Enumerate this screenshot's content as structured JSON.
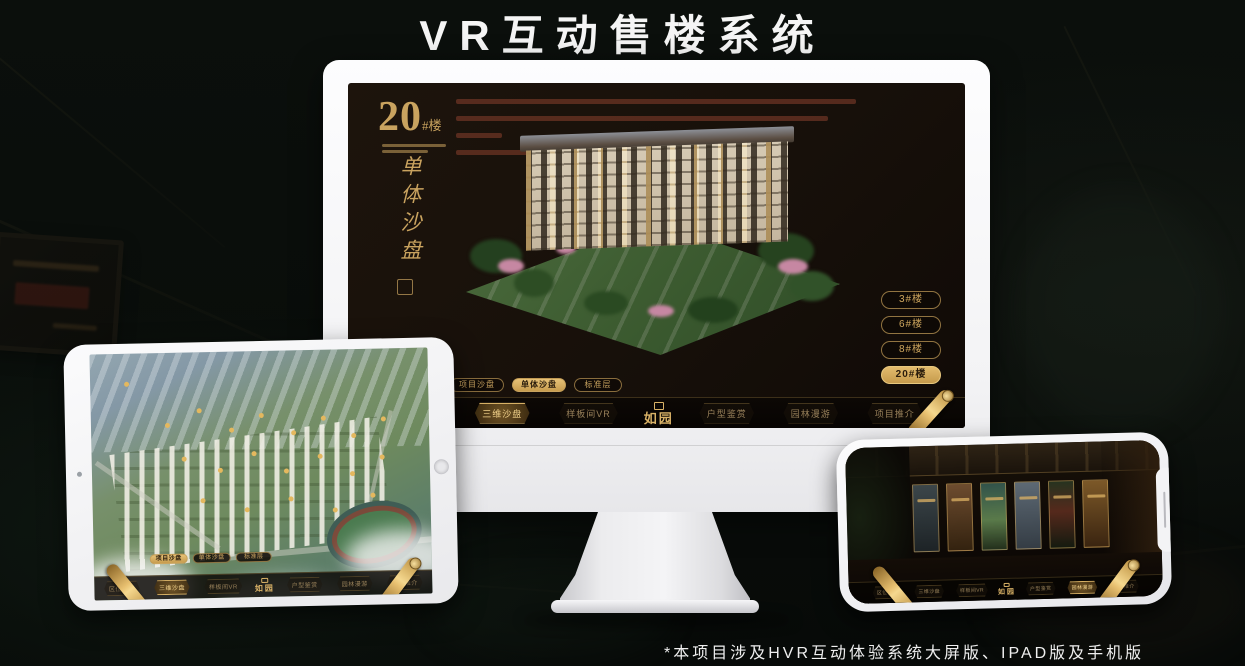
{
  "page": {
    "title": "VR互动售楼系统",
    "footnote": "*本项目涉及HVR互动体验系统大屏版、IPAD版及手机版"
  },
  "sandtable": {
    "heading_number": "20",
    "heading_unit": "#楼",
    "heading_vertical": "单体沙盘",
    "floor_buttons": [
      {
        "label": "3#楼",
        "active": false
      },
      {
        "label": "6#楼",
        "active": false
      },
      {
        "label": "8#楼",
        "active": false
      },
      {
        "label": "20#楼",
        "active": true
      }
    ]
  },
  "tabs": {
    "monitor": [
      {
        "label": "项目沙盘",
        "active": false
      },
      {
        "label": "单体沙盘",
        "active": true
      },
      {
        "label": "标准层",
        "active": false
      }
    ],
    "ipad": [
      {
        "label": "项目沙盘",
        "active": true
      },
      {
        "label": "单体沙盘",
        "active": false
      },
      {
        "label": "标准层",
        "active": false
      }
    ]
  },
  "app_menu": {
    "logo": "如园",
    "items_left": [
      {
        "label": "区位交通"
      },
      {
        "label": "三维沙盘",
        "active_on": "monitor"
      },
      {
        "label": "样板间VR"
      }
    ],
    "items_right": [
      {
        "label": "户型鉴赏"
      },
      {
        "label": "园林漫游",
        "active_on": "phone"
      },
      {
        "label": "项目推介"
      }
    ]
  },
  "colors": {
    "gold": "#c9a35f",
    "gold_bright": "#e7c277",
    "screen_dark": "#17100a",
    "background": "#090d0a"
  }
}
